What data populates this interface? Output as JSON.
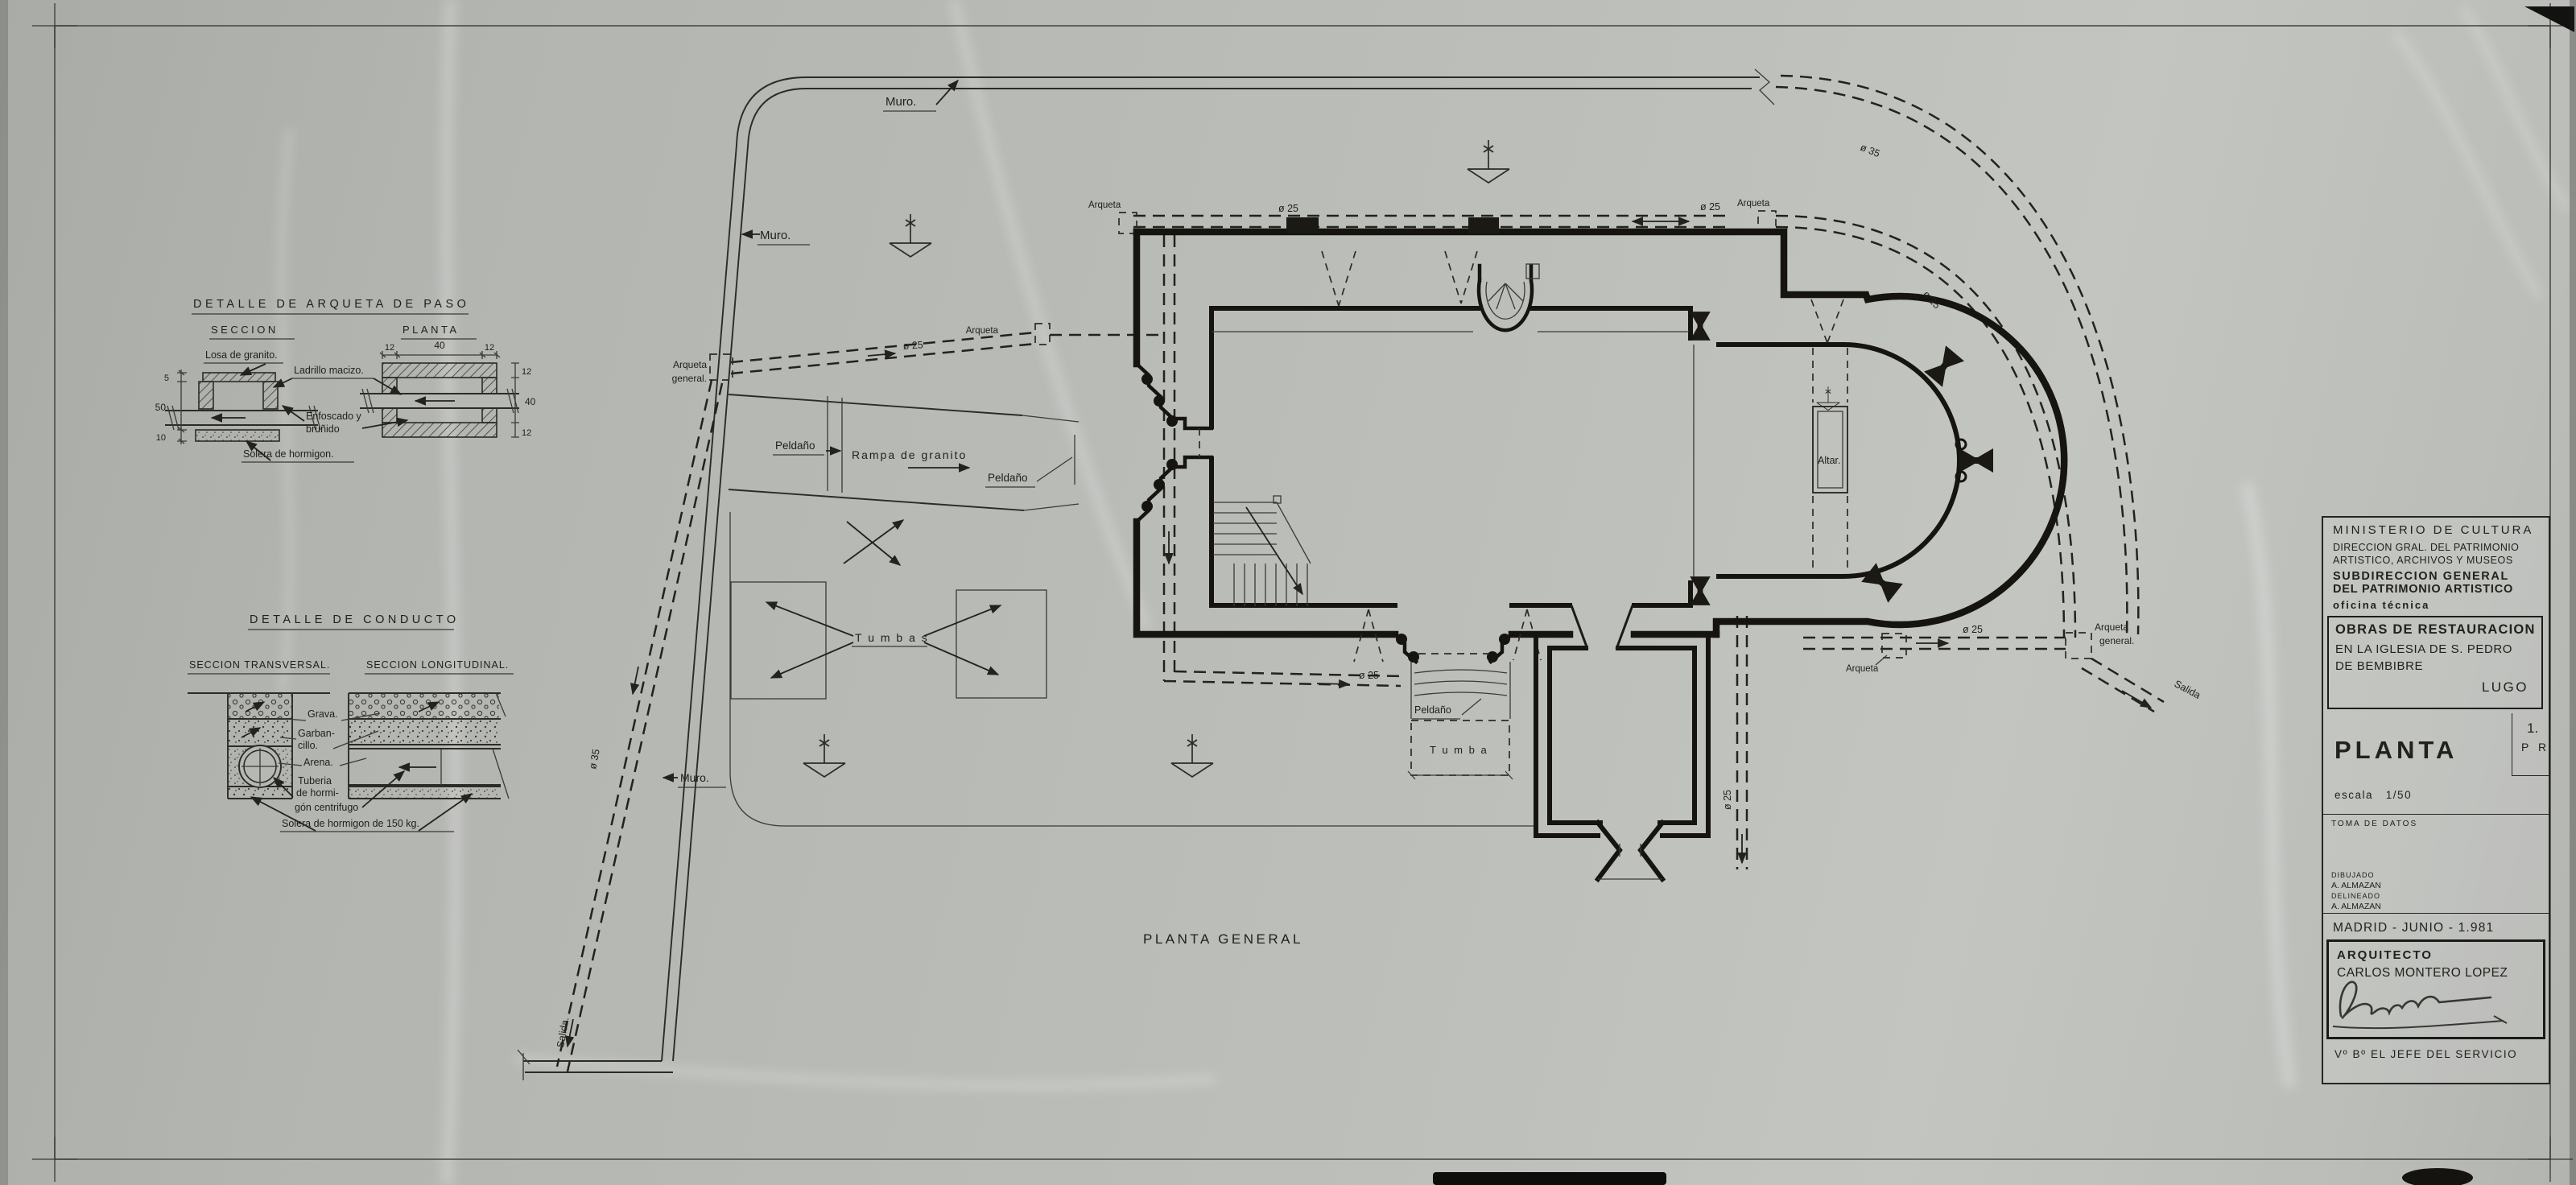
{
  "colors": {
    "paper": "#b8bab6",
    "ink": "#1d1c18"
  },
  "title_block": {
    "ministry_line1": "MINISTERIO  DE  CULTURA",
    "ministry_line2": "DIRECCION GRAL. DEL PATRIMONIO",
    "ministry_line3": "ARTISTICO, ARCHIVOS Y MUSEOS",
    "subdirection_line1": "SUBDIRECCION  GENERAL",
    "subdirection_line2": "DEL PATRIMONIO ARTISTICO",
    "office": "oficina técnica",
    "project_line1": "OBRAS DE RESTAURACION",
    "project_line2": "EN LA IGLESIA DE S. PEDRO",
    "project_line3": "DE BEMBIBRE",
    "province": "LUGO",
    "sheet_title": "PLANTA",
    "scale_label": "escala",
    "scale_value": "1/50",
    "sheet_number": "1.",
    "sheet_code": "P R",
    "phase": "TOMA  DE  DATOS",
    "drawn_label": "DIBUJADO",
    "drawn_by": "A. ALMAZAN",
    "traced_label": "DELINEADO",
    "traced_by": "A. ALMAZAN",
    "place_date": "MADRID - JUNIO - 1.981",
    "architect_label": "ARQUITECTO",
    "architect_name": "CARLOS MONTERO LOPEZ",
    "approval": "Vº Bº  EL JEFE DEL SERVICIO"
  },
  "detail_arqueta": {
    "title": "DETALLE DE ARQUETA DE PASO",
    "section_label": "SECCION",
    "plan_label": "PLANTA",
    "losa": "Losa de granito.",
    "ladrillo": "Ladrillo macizo.",
    "enfoscado1": "Enfoscado y",
    "enfoscado2": "bruñido",
    "solera": "Solera de hormigon.",
    "dims_left": [
      "5",
      "50",
      "10"
    ],
    "dims_top": [
      "12",
      "40",
      "12"
    ],
    "dims_right": [
      "12",
      "40",
      "12"
    ]
  },
  "detail_conducto": {
    "title": "DETALLE DE CONDUCTO",
    "transversal_label": "SECCION TRANSVERSAL.",
    "longitudinal_label": "SECCION LONGITUDINAL.",
    "grava": "Grava.",
    "garbancillo1": "Garban-",
    "garbancillo2": "cillo.",
    "arena": "Arena.",
    "tuberia1": "Tuberia",
    "tuberia2": "de hormi-",
    "tuberia3": "gón centrifugo",
    "solera": "Solera de hormigon de 150 kg."
  },
  "plan": {
    "caption": "PLANTA GENERAL",
    "labels": {
      "muro_top": "Muro.",
      "muro_left": "Muro.",
      "muro_bottom": "Muro.",
      "arqueta_nw": "Arqueta",
      "arqueta_west": "Arqueta",
      "arqueta_north": "Arqueta",
      "arqueta_south": "Arqueta",
      "arqueta_general_w1": "Arqueta",
      "arqueta_general_w2": "general.",
      "arqueta_general_e1": "Arqueta",
      "arqueta_general_e2": "general.",
      "salida_east": "Salida",
      "salida_west": "Salida.",
      "peldano_ramp": "Peldaño",
      "peldano_portal": "Peldaño",
      "peldano_south": "Peldaño",
      "rampa": "Rampa  de  granito",
      "tumbas": "T u m b a s",
      "tumba": "T u m b a",
      "altar": "Altar."
    },
    "pipes": {
      "north_1": "ø 25",
      "north_2": "ø 25",
      "curve_outer": "ø 35",
      "curve_inner": "ø 25",
      "west": "ø 25",
      "south": "ø 25",
      "east": "ø 25",
      "sacristy": "ø 25",
      "diagonal": "ø 35"
    }
  }
}
